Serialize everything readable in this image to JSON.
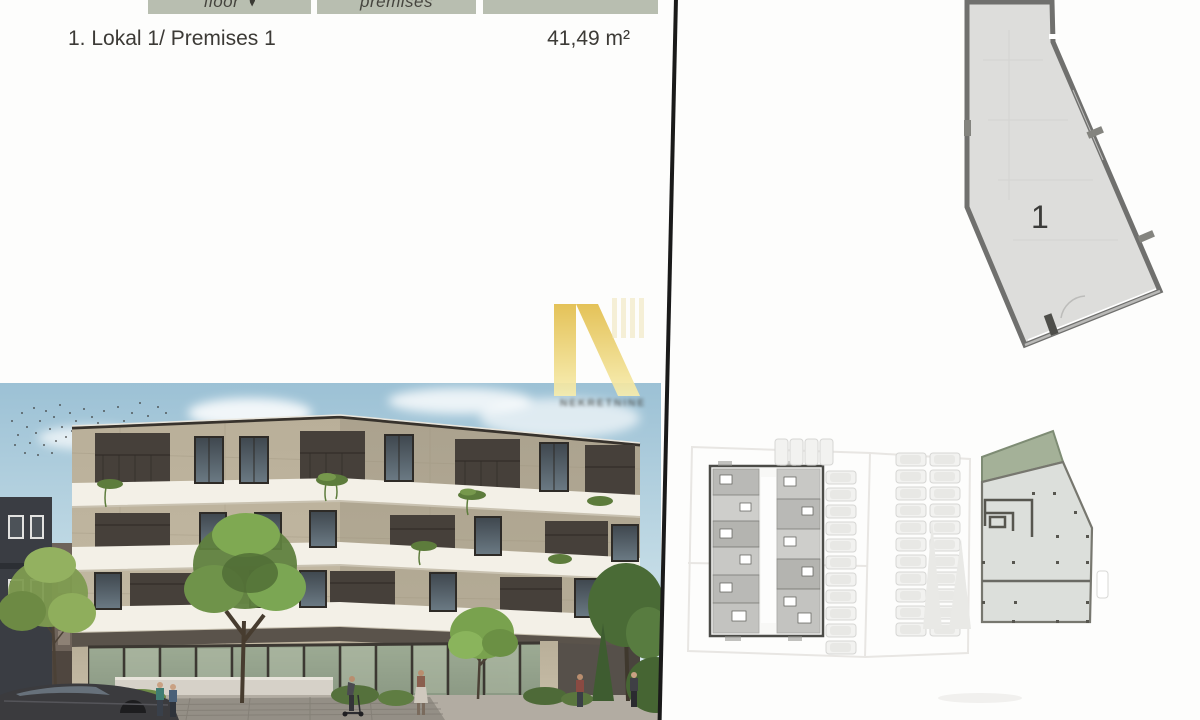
{
  "header_table": {
    "columns": [
      {
        "label": "floor"
      },
      {
        "label": "premises"
      },
      {
        "label": ""
      }
    ]
  },
  "listing": {
    "name": "1. Lokal 1/ Premises 1",
    "area": "41,49 m²"
  },
  "watermark": {
    "text": "NEKRETNINE"
  },
  "unit_plan": {
    "unit_number": "1"
  },
  "colors": {
    "header_bg": "#b8beb0",
    "header_text": "#45443e",
    "body_text": "#3c3a36",
    "divider": "#1a1a1a",
    "watermark_gold": "#e8c95c",
    "plan_wall": "#70706e",
    "plan_floor": "#dcdcda",
    "lawn_green": "#a4b198"
  }
}
